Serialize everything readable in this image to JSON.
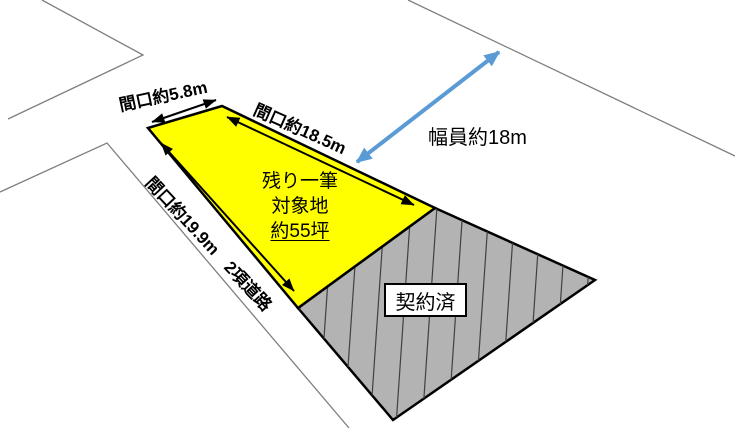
{
  "diagram": {
    "parcel": {
      "line1": "残り一筆",
      "line2": "対象地",
      "line3": "約55坪"
    },
    "dimensions": {
      "frontage_top": "間口約5.8m",
      "frontage_upper_right": "間口約18.5m",
      "frontage_left": "間口約19.9m",
      "road_type": "2項道路",
      "road_width": "幅員約18m"
    },
    "contracted_label": "契約済",
    "colors": {
      "parcel_fill": "#FFFF00",
      "contracted_fill": "#B3B3B3",
      "road_width_arrow": "#5B9BD5",
      "outline": "#000000",
      "road_line": "#7F7F7F",
      "hatch_line": "#404040"
    }
  }
}
